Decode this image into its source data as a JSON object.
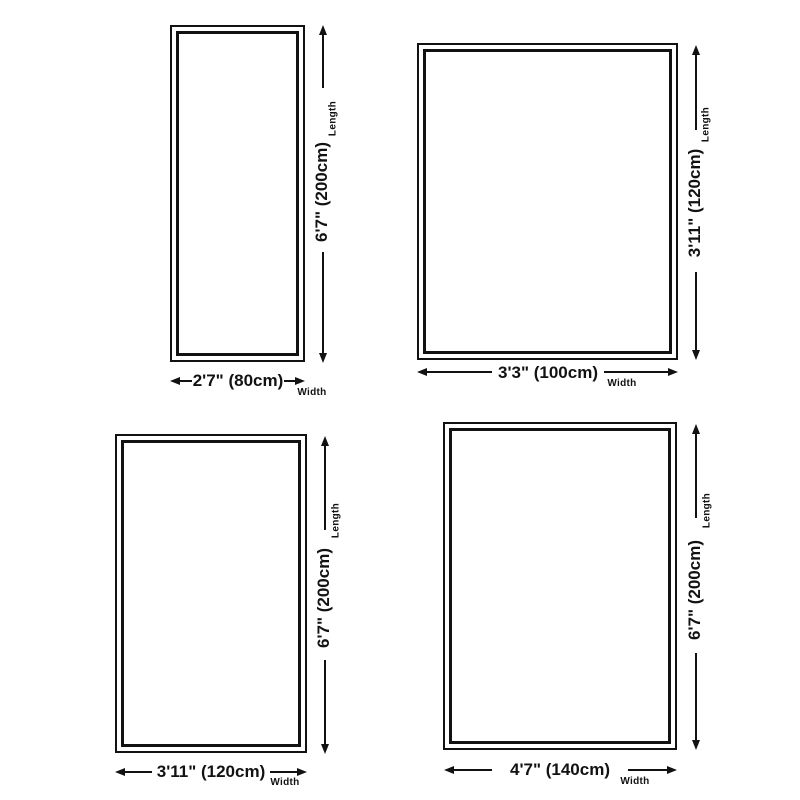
{
  "canvas": {
    "background_color": "#ffffff",
    "line_color": "#121212"
  },
  "diagrams": [
    {
      "position": "top-left",
      "length_value": "6'7\" (200cm)",
      "length_axis": "Length",
      "width_value": "2'7\" (80cm)",
      "width_axis": "Width"
    },
    {
      "position": "top-right",
      "length_value": "3'11\" (120cm)",
      "length_axis": "Length",
      "width_value": "3'3\" (100cm)",
      "width_axis": "Width"
    },
    {
      "position": "bottom-left",
      "length_value": "6'7\" (200cm)",
      "length_axis": "Length",
      "width_value": "3'11\" (120cm)",
      "width_axis": "Width"
    },
    {
      "position": "bottom-right",
      "length_value": "6'7\" (200cm)",
      "length_axis": "Length",
      "width_value": "4'7\" (140cm)",
      "width_axis": "Width"
    }
  ]
}
